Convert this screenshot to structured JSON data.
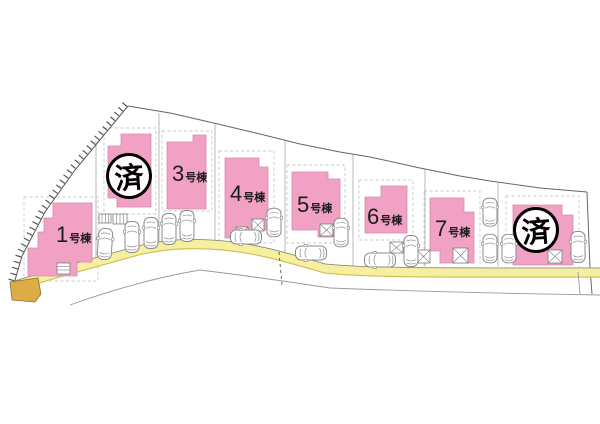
{
  "page": {
    "type": "real-estate-site-plan",
    "background": "#ffffff"
  },
  "buildings": [
    {
      "id": "1",
      "label_num": "1",
      "label_suffix": "号棟",
      "status": "available"
    },
    {
      "id": "2",
      "label_num": "",
      "label_suffix": "",
      "status": "sold",
      "stamp": "済"
    },
    {
      "id": "3",
      "label_num": "3",
      "label_suffix": "号棟",
      "status": "available"
    },
    {
      "id": "4",
      "label_num": "4",
      "label_suffix": "号棟",
      "status": "available"
    },
    {
      "id": "5",
      "label_num": "5",
      "label_suffix": "号棟",
      "status": "available"
    },
    {
      "id": "6",
      "label_num": "6",
      "label_suffix": "号棟",
      "status": "available"
    },
    {
      "id": "7",
      "label_num": "7",
      "label_suffix": "号棟",
      "status": "available"
    },
    {
      "id": "8",
      "label_num": "",
      "label_suffix": "",
      "status": "sold",
      "stamp": "済"
    }
  ],
  "parking": {
    "car_count": 15
  },
  "colors": {
    "building_pink": "#F0A1C4",
    "road_yellow": "#F7EFA0",
    "road_start_gold": "#DFAB47",
    "boundary_gray": "#666666",
    "stamp_black": "#000000"
  }
}
